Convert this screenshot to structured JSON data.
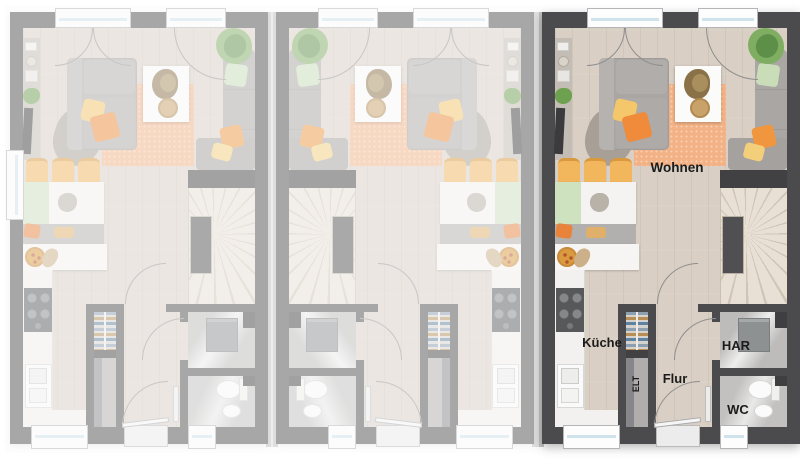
{
  "room_labels": {
    "living": "Wohnen",
    "kitchen": "Küche",
    "utility": "HAR",
    "hallway": "Flur",
    "wc": "WC",
    "electrical": "ELT"
  },
  "units": [
    {
      "name": "house-unit-left",
      "variant": "faded",
      "mirrored": false,
      "side_window": "left"
    },
    {
      "name": "house-unit-middle",
      "variant": "faded",
      "mirrored": true,
      "side_window": "none"
    },
    {
      "name": "house-unit-right",
      "variant": "highlighted",
      "mirrored": false,
      "side_window": "none"
    }
  ],
  "colors": {
    "wall_dark": "#4b4b4d",
    "wall_faded": "#a2a2a3",
    "floor_wood": "#d9cfc4",
    "rug_orange": "#f3b285",
    "accent_orange": "#ef8b3a",
    "accent_yellow": "#f4c76a",
    "accent_green": "#c9ddb8",
    "sofa_gray": "#a9a6a3",
    "tile_gray": "#bdbcbb",
    "glass_blue": "#cfe3ec",
    "label_text": "#1b1b1b",
    "background": "#ffffff"
  }
}
